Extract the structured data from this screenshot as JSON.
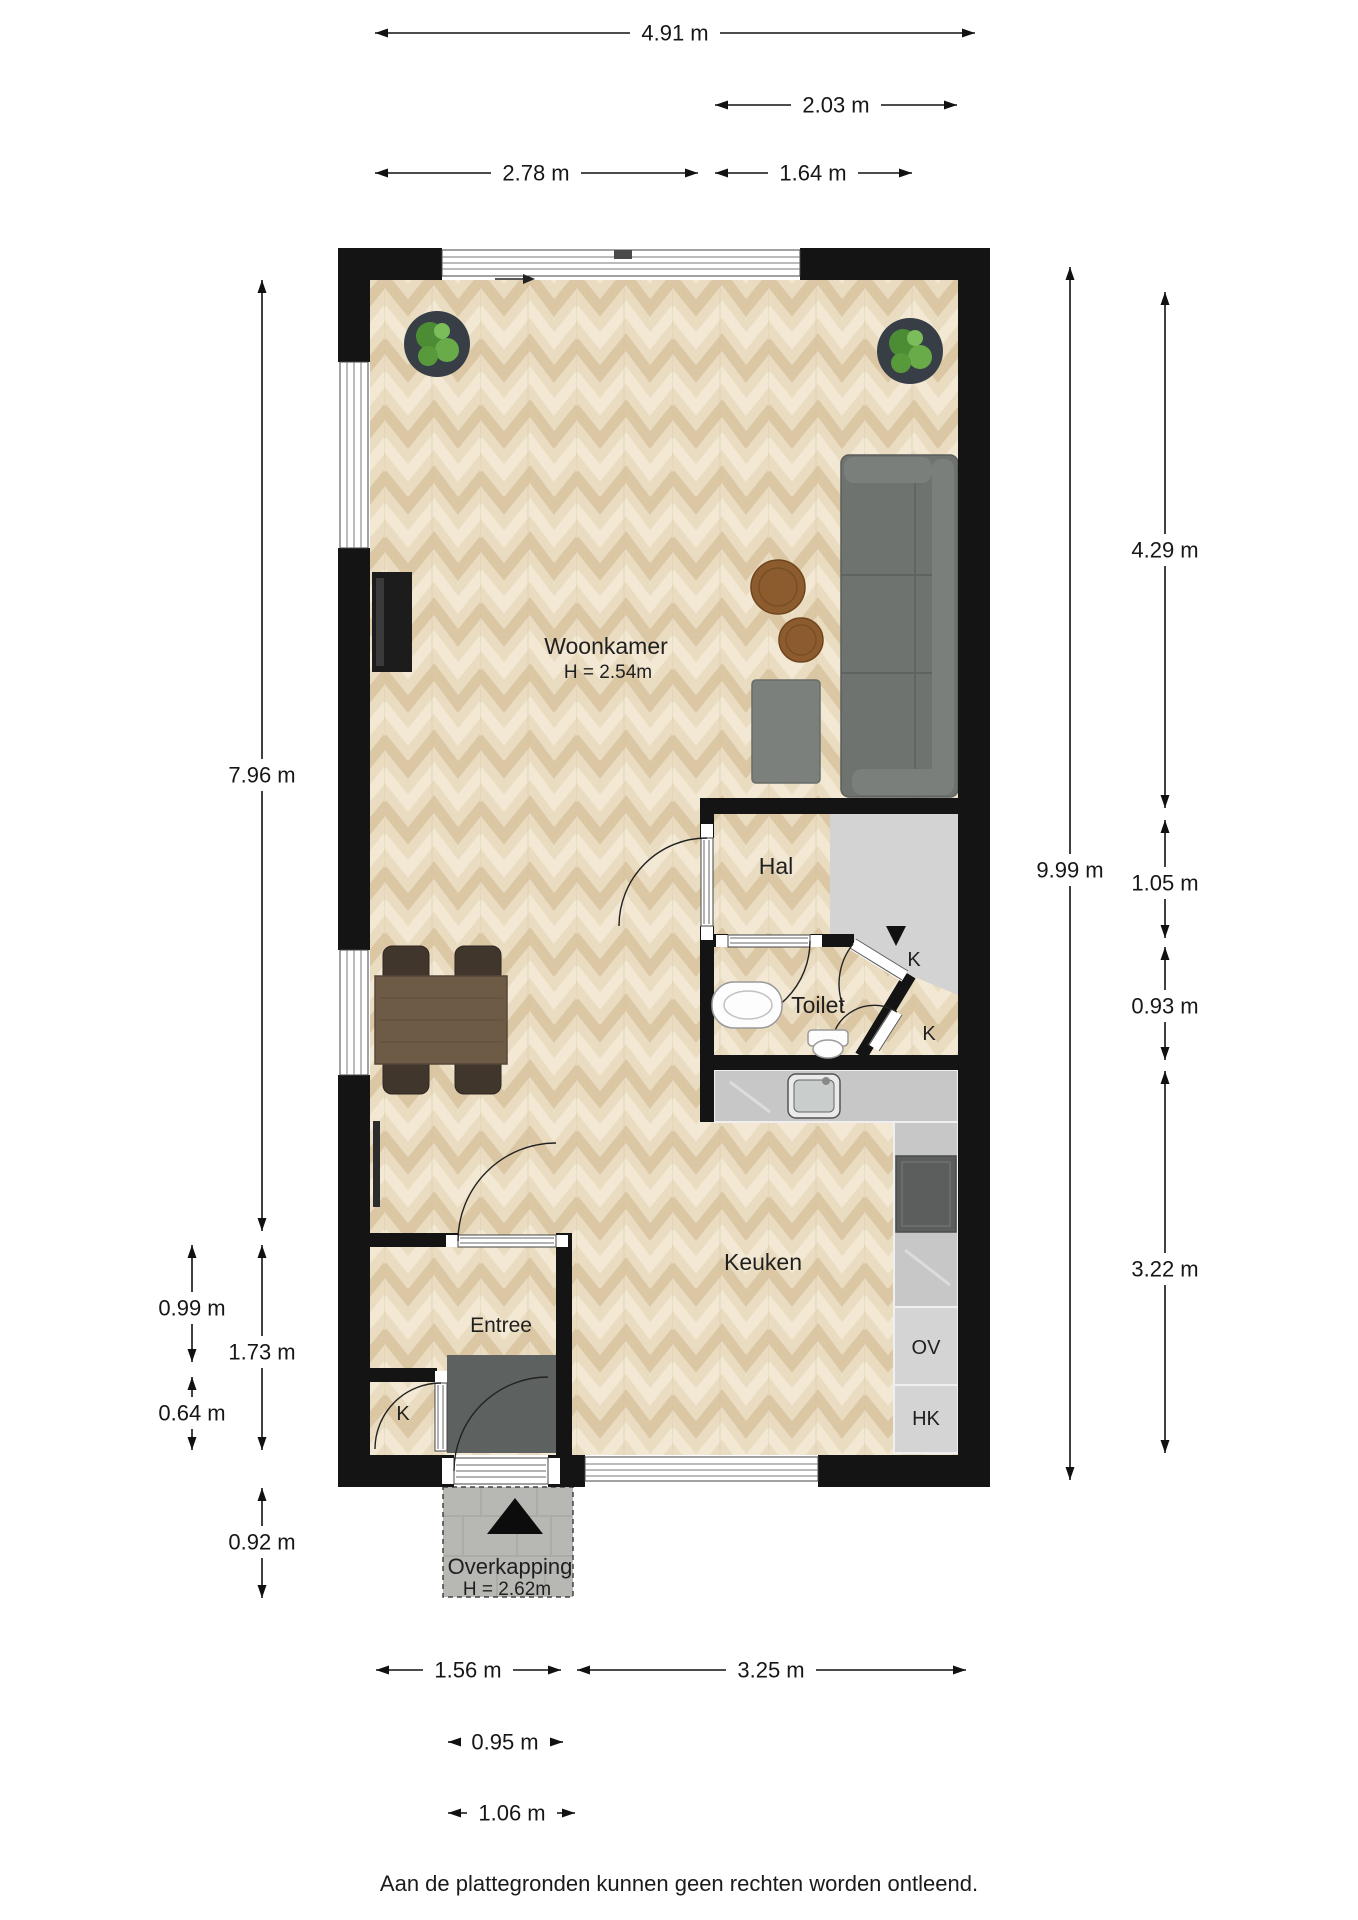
{
  "plan": {
    "rooms": {
      "woonkamer": {
        "name": "Woonkamer",
        "height": "H = 2.54m"
      },
      "hal": {
        "name": "Hal"
      },
      "toilet": {
        "name": "Toilet"
      },
      "keuken": {
        "name": "Keuken"
      },
      "entree": {
        "name": "Entree"
      },
      "overkapping": {
        "name": "Overkapping",
        "height": "H = 2.62m"
      }
    },
    "closets": [
      "K",
      "K",
      "K"
    ],
    "appliances": {
      "oven": "OV",
      "tall_cabinet": "HK"
    }
  },
  "dimensions": {
    "top": [
      "4.91 m",
      "2.03 m",
      "2.78 m",
      "1.64 m"
    ],
    "left": [
      "7.96 m",
      "0.99 m",
      "1.73 m",
      "0.64 m",
      "0.92 m"
    ],
    "right": [
      "9.99 m",
      "4.29 m",
      "1.05 m",
      "0.93 m",
      "3.22 m"
    ],
    "bottom": [
      "1.56 m",
      "3.25 m",
      "0.95 m",
      "1.06 m"
    ]
  },
  "footer": {
    "disclaimer": "Aan de plattegronden kunnen geen rechten worden ontleend."
  },
  "colors": {
    "wall": "#141414",
    "floor_wood": "#e9dcc1",
    "floor_gray": "#d3d3d3",
    "counter": "#c7c7c8",
    "sofa_gray": "#6f736f",
    "table_brown": "#8c5c2e",
    "plant_green": "#5da23e"
  }
}
